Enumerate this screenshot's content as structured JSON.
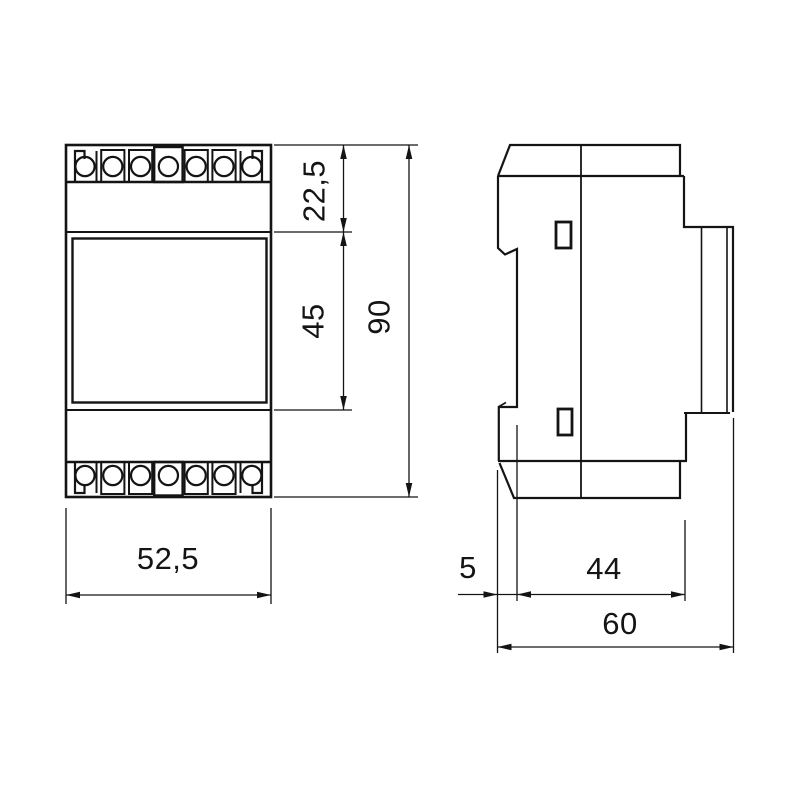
{
  "drawing": {
    "type": "technical-dimension-drawing",
    "subject": "DIN-rail modular device, front and side views",
    "units": "mm",
    "colors": {
      "background": "#ffffff",
      "line": "#141414"
    },
    "front_view": {
      "labels": {
        "top_section": "22,5",
        "face_section": "45",
        "total_height": "90",
        "total_width": "52,5"
      },
      "terminals_per_row": 7,
      "terminal_rows": 2
    },
    "side_view": {
      "labels": {
        "rail_clip_depth": "5",
        "body_depth": "44",
        "total_depth": "60"
      }
    }
  }
}
